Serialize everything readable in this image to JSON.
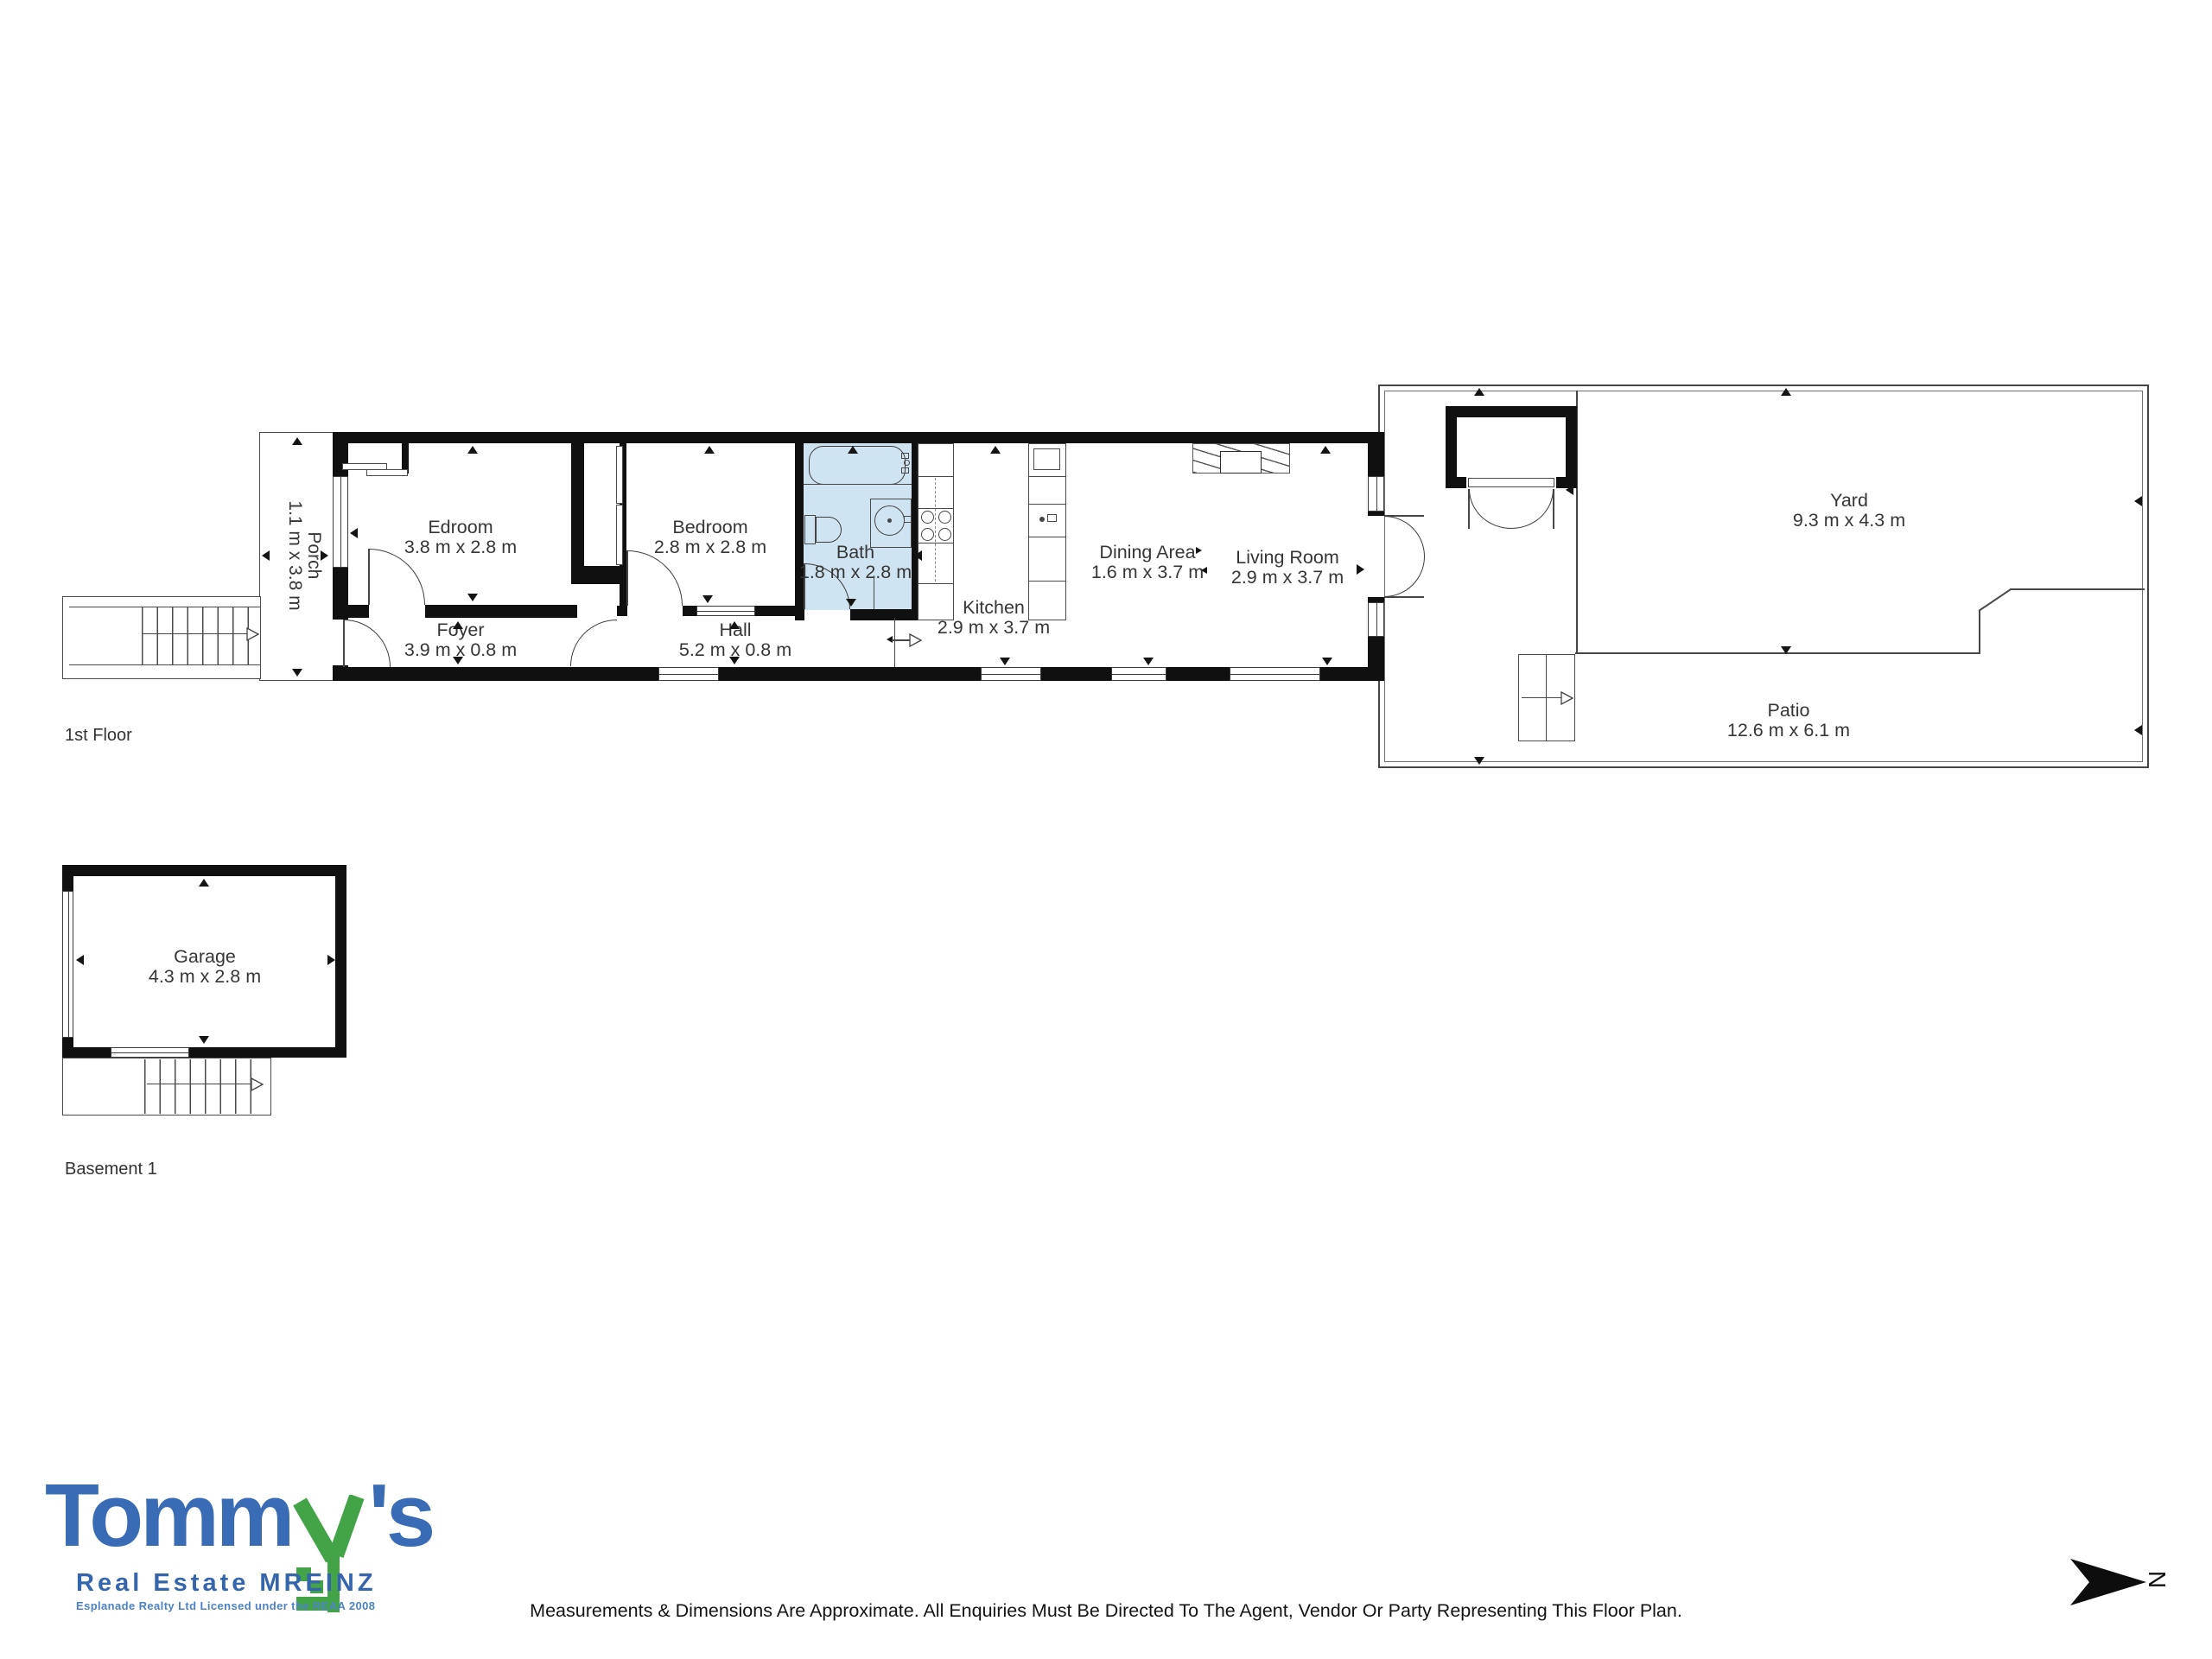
{
  "floors": {
    "first": {
      "label": "1st Floor"
    },
    "basement": {
      "label": "Basement 1"
    }
  },
  "rooms": {
    "porch": {
      "name": "Porch",
      "dims": "1.1 m x 3.8 m"
    },
    "edroom": {
      "name": "Edroom",
      "dims": "3.8 m x 2.8 m"
    },
    "bedroom": {
      "name": "Bedroom",
      "dims": "2.8 m x 2.8 m"
    },
    "bath": {
      "name": "Bath",
      "dims": "1.8 m x 2.8 m"
    },
    "foyer": {
      "name": "Foyer",
      "dims": "3.9 m x 0.8 m"
    },
    "hall": {
      "name": "Hall",
      "dims": "5.2 m x 0.8 m"
    },
    "kitchen": {
      "name": "Kitchen",
      "dims": "2.9 m x 3.7 m"
    },
    "dining": {
      "name": "Dining Area",
      "dims": "1.6 m x 3.7 m"
    },
    "living": {
      "name": "Living Room",
      "dims": "2.9 m x 3.7 m"
    },
    "yard": {
      "name": "Yard",
      "dims": "9.3 m x 4.3 m"
    },
    "patio": {
      "name": "Patio",
      "dims": "12.6 m x 6.1 m"
    },
    "garage": {
      "name": "Garage",
      "dims": "4.3 m x 2.8 m"
    }
  },
  "logo": {
    "word_main": "Tomm",
    "word_key": "y",
    "word_suffix": "'s",
    "line2": "Real Estate MREINZ",
    "line3": "Esplanade Realty Ltd Licensed under the REAA 2008"
  },
  "footer": {
    "disclaimer": "Measurements & Dimensions Are Approximate. All Enquiries Must Be Directed To The Agent, Vendor Or Party Representing This Floor Plan."
  },
  "compass": {
    "label": "N"
  },
  "colors": {
    "bath_fill": "#cfe4f2",
    "wall": "#101010",
    "line": "#474747",
    "logo_blue": "#3a6cb5",
    "logo_green": "#43a447",
    "logo_light_blue": "#4d82c4"
  }
}
